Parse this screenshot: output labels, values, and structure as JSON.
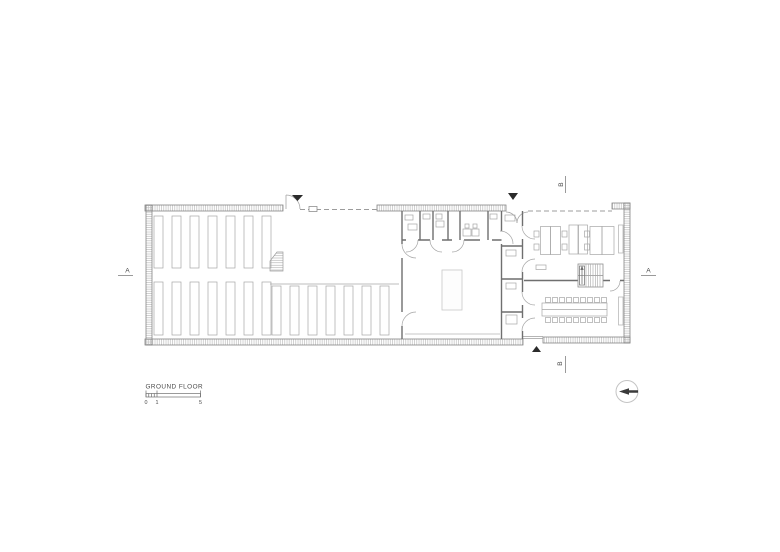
{
  "drawing": {
    "title": "GROUND FLOOR",
    "scale_bar": {
      "labels": [
        "0",
        "1",
        "5"
      ]
    },
    "section_markers": {
      "a_left": "A",
      "a_right": "A",
      "b_top": "B",
      "b_bottom": "B"
    }
  },
  "icons": {
    "entrance_marker_top_left": "filled-triangle-down",
    "entrance_marker_top_mid": "filled-triangle-down",
    "entrance_marker_bottom": "filled-triangle-up",
    "north_arrow": "circle-with-left-arrow"
  },
  "colors": {
    "background": "#ffffff",
    "outer_wall_line": "#858585",
    "wall_hatch": "#bdbdbd",
    "partition_wall": "#6f6f6f",
    "furniture": "#a6a6a6",
    "thin_line": "#9c9c9c",
    "door_arc": "#a5a5a5",
    "marker_dark": "#2b2b2b",
    "annotation_text": "#4a4a4a"
  }
}
